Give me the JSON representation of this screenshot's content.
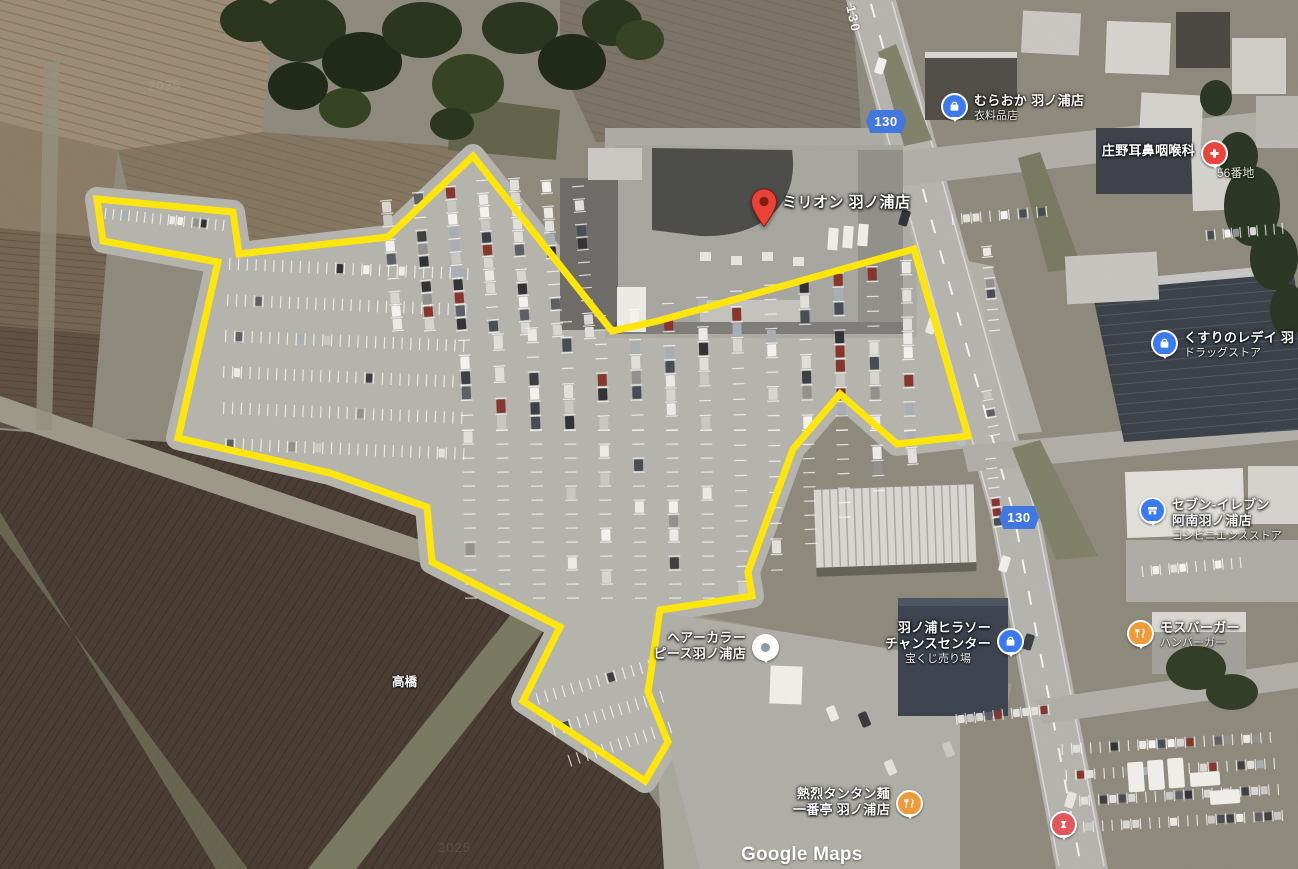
{
  "map": {
    "attribution": {
      "watermark": "Google Maps",
      "imagery_year": "2025"
    },
    "road": {
      "route_number": "130",
      "road_label": "130"
    },
    "colors": {
      "highlight_outline": "#FFE60A",
      "route_shield_blue": "#4277E0",
      "poi_blue": "#3A7BF2",
      "poi_orange": "#F09B37",
      "medical_red": "#E8453C",
      "place_pin_red": "#EA4335"
    },
    "searched_place": {
      "label": "ミリオン 羽ノ浦店"
    },
    "address_label": "56番地",
    "bridge_label": "高橋",
    "pois": {
      "muraoka": {
        "name": "むらおか 羽ノ浦店",
        "category": "衣料品店"
      },
      "shono_clinic": {
        "name": "庄野耳鼻咽喉科"
      },
      "kusuri_lady": {
        "name": "くすりのレデイ 羽",
        "category": "ドラッグストア"
      },
      "seven_eleven": {
        "name_line1": "セブン-イレブン",
        "name_line2": "阿南羽ノ浦店",
        "category": "コンビニエンスストア"
      },
      "mos_burger": {
        "name": "モスバーガー",
        "category": "ハンバーガー"
      },
      "hiraso": {
        "name_line1": "羽ノ浦ヒラソー",
        "name_line2": "チャンスセンター",
        "category": "宝くじ売り場"
      },
      "hair_salon": {
        "name_line1": "ヘアーカラー",
        "name_line2": "ピース羽ノ浦店"
      },
      "ramen": {
        "name_line1": "熱烈タンタン麺",
        "name_line2": "一番亭 羽ノ浦店"
      }
    }
  }
}
